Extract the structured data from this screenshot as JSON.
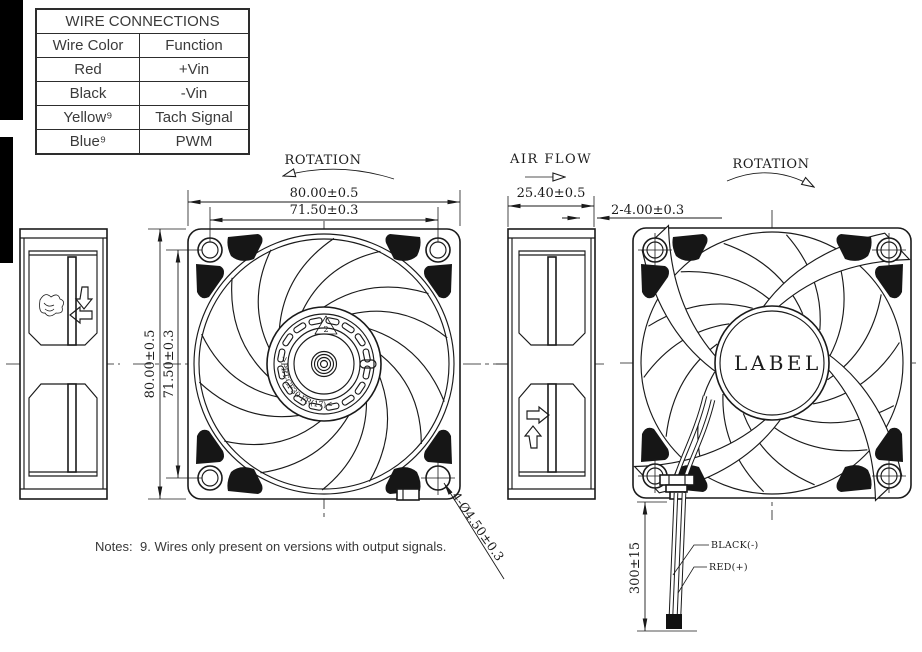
{
  "table": {
    "title": "WIRE CONNECTIONS",
    "headers": [
      "Wire Color",
      "Function"
    ],
    "rows": [
      [
        "Red",
        "+Vin"
      ],
      [
        "Black",
        "-Vin"
      ],
      [
        "Yellow⁹",
        "Tach Signal"
      ],
      [
        "Blue⁹",
        "PWM"
      ]
    ]
  },
  "views": {
    "front": {
      "rotation_label": "ROTATION",
      "dim_width_outer": "80.00±0.5",
      "dim_width_inner": "71.50±0.3",
      "dim_height_outer": "80.00±0.5",
      "dim_height_inner": "71.50±0.3",
      "dim_mounting_holes": "4-Ø4.50±0.3",
      "hub_material_text": ">PBT-GF30-FR(17)<",
      "hub_recycle_code": "2"
    },
    "side": {
      "airflow_label": "AIR FLOW",
      "dim_depth": "25.40±0.5",
      "dim_flange_thickness": "2-4.00±0.3"
    },
    "rear": {
      "rotation_label": "ROTATION",
      "hub_label": "LABEL",
      "dim_lead_length": "300±15",
      "wire_label_black": "BLACK(-)",
      "wire_label_red": "RED(+)"
    }
  },
  "notes": {
    "prefix": "Notes:",
    "text": "9. Wires only present on versions with output signals."
  }
}
